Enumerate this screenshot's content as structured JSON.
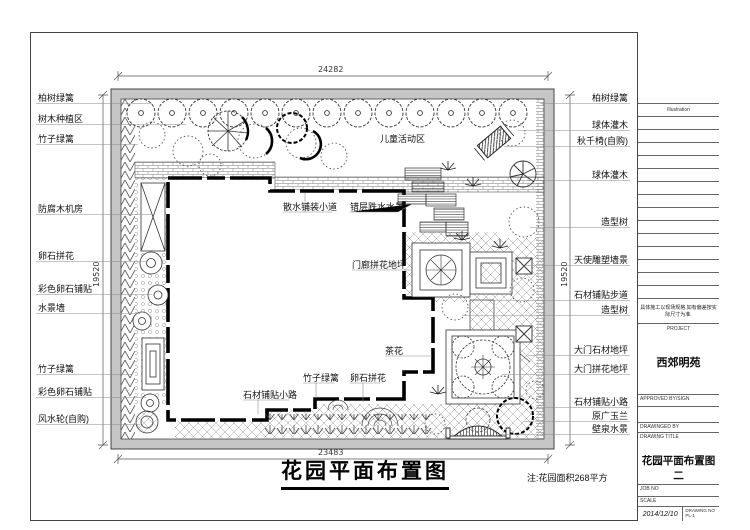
{
  "sheet": {
    "main_title": "花园平面布置图",
    "area_note": "注:花园面积268平方",
    "play_area": "儿童活动区"
  },
  "dimensions": {
    "top": "24282",
    "bottom": "23483",
    "left": "19520",
    "right": "19520"
  },
  "labels_left": [
    "柏树绿篱",
    "树木种植区",
    "竹子绿篱",
    "防腐木机房",
    "卵石拼花",
    "彩色卵石铺贴",
    "水景墙",
    "竹子绿篱",
    "彩色卵石铺贴",
    "风水轮(自购)"
  ],
  "labels_right": [
    "柏树绿篱",
    "球体灌木",
    "秋千椅(自购)",
    "球体灌木",
    "造型树",
    "天使雕塑墙景",
    "石材铺贴步道",
    "造型树",
    "大门石材地坪",
    "大门拼花地坪",
    "石材铺贴小路",
    "原广玉兰",
    "壁泉水景"
  ],
  "labels_plan": [
    "散水铺装小道",
    "错层跌水水景",
    "门廊拼花地坪",
    "茶花",
    "竹子绿篱",
    "卵石拼花",
    "石材铺贴小路"
  ],
  "title_block": {
    "illustration": "Illustration",
    "construction_note": "具体施工以现场规格,如有偏差按实际尺寸为准.",
    "project_label": "PROJECT",
    "project_name": "西郊明苑",
    "approved_label": "APPROVED BY/SIGN",
    "drawn_label": "DRAWINGED BY",
    "title_label": "DRAWING TITLE",
    "drawing_title": "花园平面布置图二",
    "job_no_label": "JOB NO",
    "scale_label": "SCALE",
    "date_label": "DATE",
    "date_value": "2014/12/10",
    "drawing_no_label": "DRAWING NO",
    "drawing_no_value": "PL-1"
  },
  "colors": {
    "wall_gray": "#c6c6c6",
    "line": "#333333",
    "leader": "#8a8a8a"
  }
}
